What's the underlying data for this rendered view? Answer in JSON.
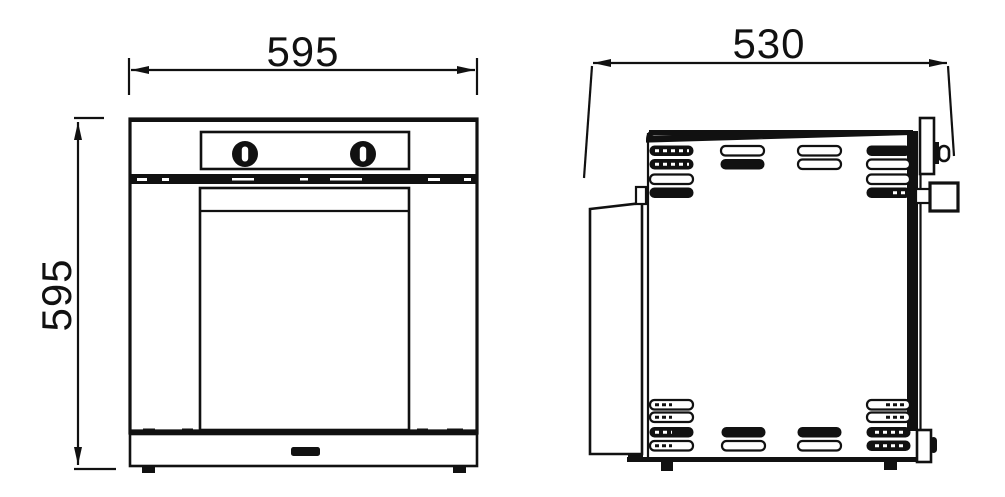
{
  "diagram": {
    "front_view": {
      "width_label": "595",
      "height_label": "595"
    },
    "side_view": {
      "depth_label": "530"
    }
  },
  "colors": {
    "line": "#111111",
    "background": "#ffffff"
  }
}
